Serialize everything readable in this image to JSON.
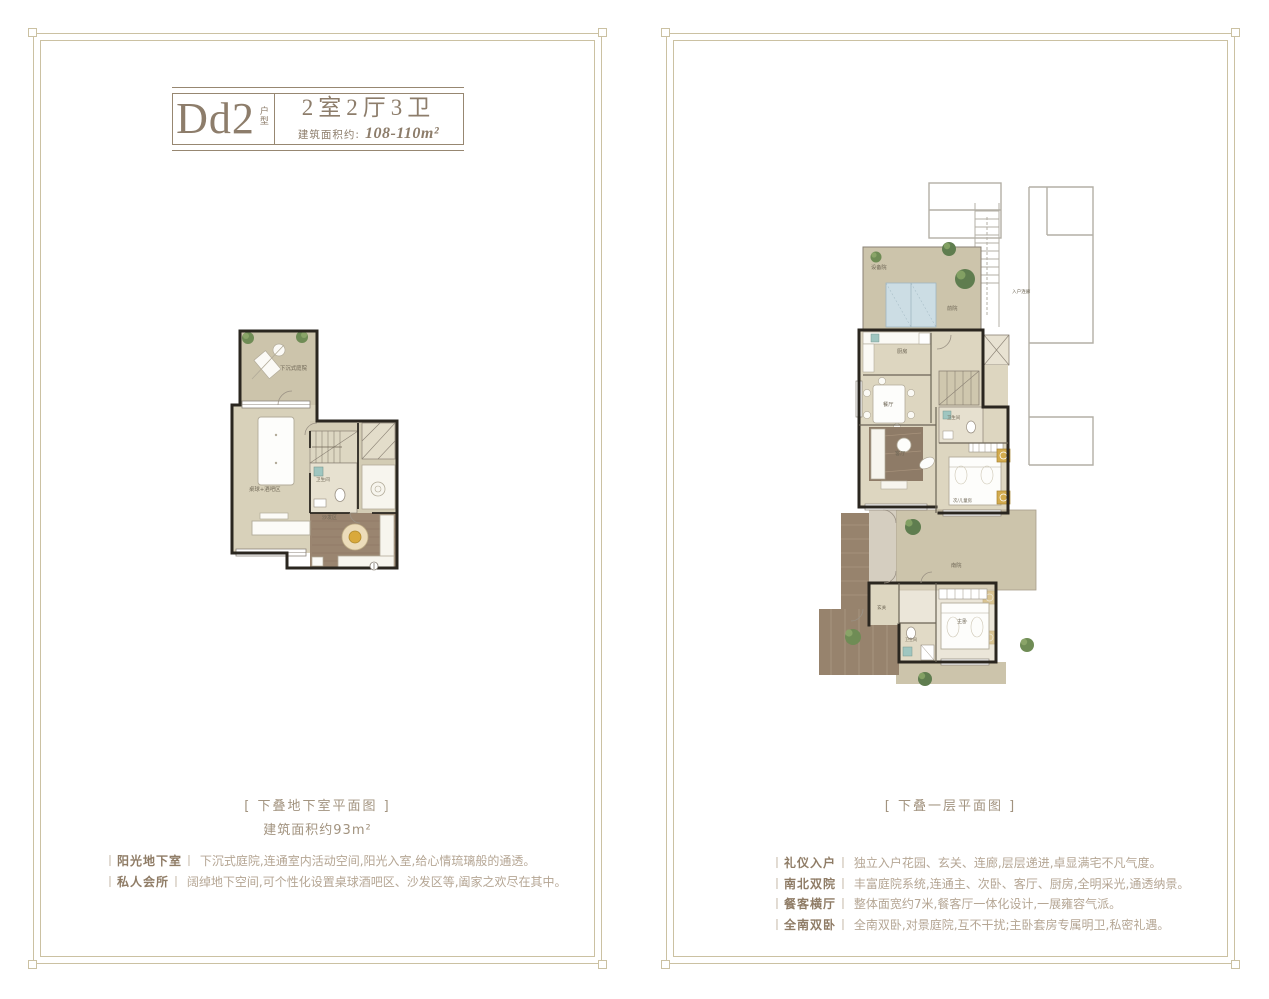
{
  "ui": {
    "bracket": "丨"
  },
  "left_panel": {
    "title": {
      "code": "Dd2",
      "code_tag": "户型",
      "layout": "2室2厅3卫",
      "area_label": "建筑面积约:",
      "area_value": "108-110m²"
    },
    "plan_labels": {
      "sunken_courtyard": "下沉式庭院",
      "billiard_bar": "桌球+酒吧区",
      "bathroom": "卫生间",
      "sofa_area": "沙发区"
    },
    "caption": "[ 下叠地下室平面图 ]",
    "caption_sub": "建筑面积约93m²",
    "bullets": [
      {
        "label": "阳光地下室",
        "text": "下沉式庭院,连通室内活动空间,阳光入室,给心情琉璃般的通透。"
      },
      {
        "label": "私人会所",
        "text": "阔绰地下空间,可个性化设置桌球酒吧区、沙发区等,阖家之欢尽在其中。"
      }
    ]
  },
  "right_panel": {
    "plan_labels": {
      "equipment_yard": "设备院",
      "front_yard": "前院",
      "entry_corridor": "入户连廊",
      "kitchen": "厨房",
      "dining": "餐厅",
      "living": "客厅",
      "bathroom": "卫生间",
      "kids_room": "次/儿童房",
      "south_yard": "南院",
      "foyer": "玄关",
      "master_bath": "卫生间",
      "master_bedroom": "主卧"
    },
    "caption": "[ 下叠一层平面图 ]",
    "bullets": [
      {
        "label": "礼仪入户",
        "text": "独立入户花园、玄关、连廊,层层递进,卓显满宅不凡气度。"
      },
      {
        "label": "南北双院",
        "text": "丰富庭院系统,连通主、次卧、客厅、厨房,全明采光,通透纳景。"
      },
      {
        "label": "餐客横厅",
        "text": "整体面宽约7米,餐客厅一体化设计,一展雍容气派。"
      },
      {
        "label": "全南双卧",
        "text": "全南双卧,对景庭院,互不干扰;主卧套房专属明卫,私密礼遇。"
      }
    ]
  },
  "colors": {
    "frame": "#cbc1a2",
    "title_text": "#8d7d6b",
    "body_text": "#b5a694",
    "label_text": "#8f7c66",
    "wall": "#2a261f",
    "floor": "#d8d1ba",
    "yard": "#ccc4ab",
    "wood": "#9a8570",
    "plant": "#6f8c55",
    "equipment_blue": "#ccdde4",
    "ac_yellow": "#d2ab4e"
  }
}
